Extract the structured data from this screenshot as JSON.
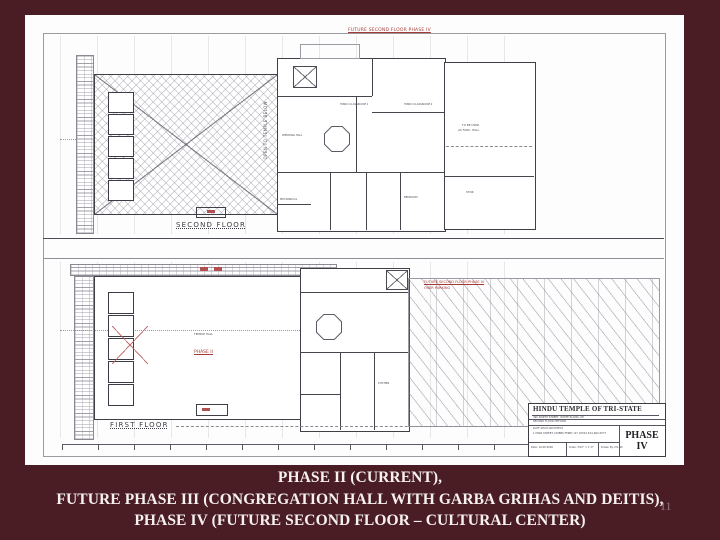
{
  "slide": {
    "background_color": "#4a1d25",
    "caption_color": "#f6f1ee",
    "page_number": "11",
    "caption": {
      "line1": "PHASE II (CURRENT),",
      "line2": "FUTURE PHASE III (CONGREGATION HALL WITH GARBA GRIHAS AND DEITIS),",
      "line3": "PHASE IV (FUTURE SECOND FLOOR – CULTURAL CENTER)"
    }
  },
  "drawing": {
    "colors": {
      "annotation_red": "#a33a36",
      "wall_line": "#3f3f47",
      "sheet_border": "#9a9aa0"
    },
    "second_floor": {
      "future_label": "FUTURE SECOND FLOOR PHASE IV",
      "floor_label": "SECOND FLOOR",
      "open_label": "OPEN TO TEMPLE BELOW",
      "classroom1": "HINDU CLASSROOM 1",
      "classroom2": "HINDU CLASSROOM 2",
      "wedding_hall": "WEDDING HALL",
      "mechanical": "MECHANICAL",
      "bedroom": "BEDROOM",
      "func_line1": "TO BE USED",
      "func_line2": "AS FUNC. HALL",
      "stor": "STOR"
    },
    "first_floor": {
      "floor_label": "FIRST FLOOR",
      "phase_label": "PHASE II",
      "hall_label": "TEMPLE HALL",
      "kitchen": "KITCHEN",
      "parking_line1": "FUTURE SECOND FLOOR PHASE IV",
      "parking_line2": "OVER PARKING"
    },
    "title_block": {
      "project": "HINDU TEMPLE OF TRI-STATE",
      "address": "390 NORTH STREET, WHITE PLAINS, NY",
      "sheet_title": "SECOND FLOOR OPTIONS",
      "architect1": "DATT SHAH ARCHITECT",
      "architect2": "1 MAIN STREET, DOBBS FERRY, NY 10522  914-962-0577",
      "date": "Date: 10.08.2006",
      "scale": "Scale: 3/32\" = 1'-0\"",
      "drawn": "Drawn By: DS, SP",
      "phase_word": "PHASE",
      "phase_num": "IV"
    }
  }
}
